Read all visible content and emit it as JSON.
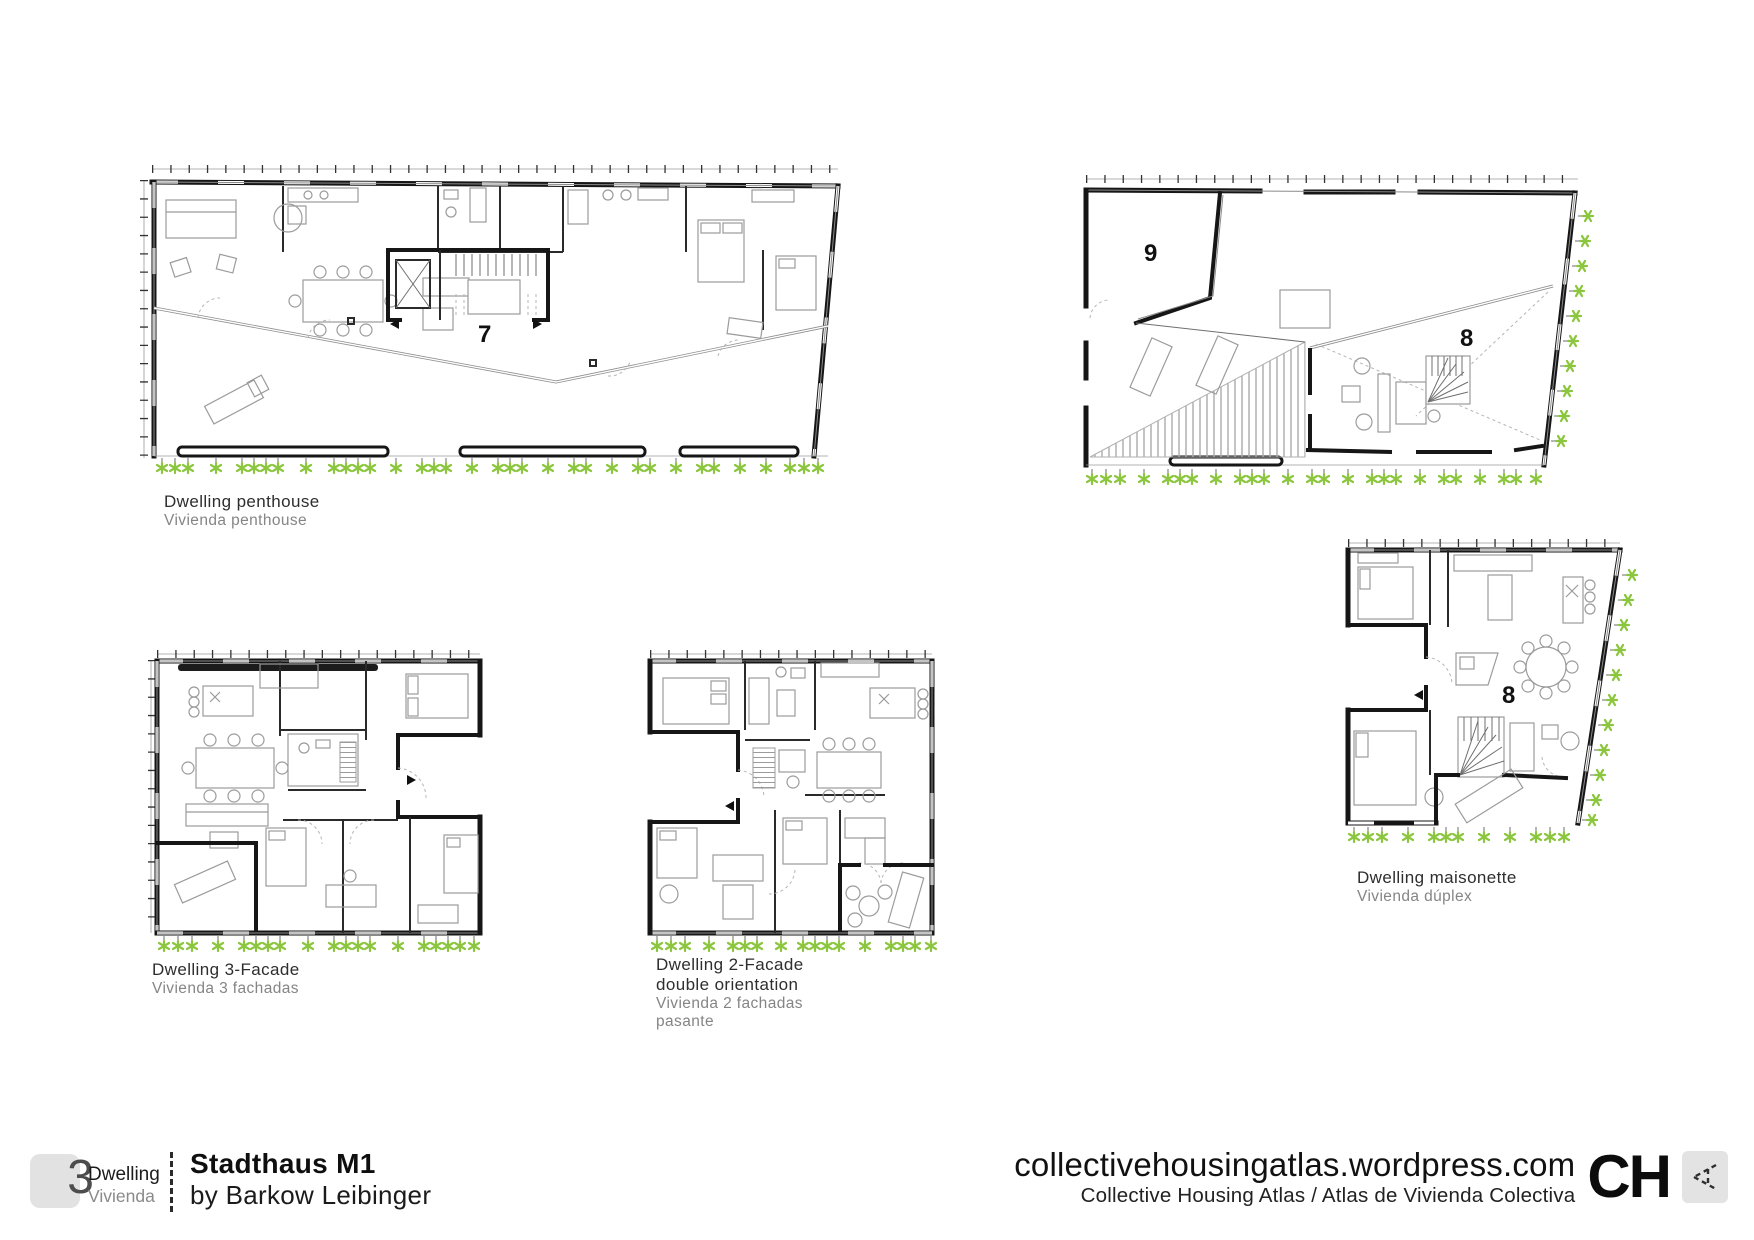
{
  "colors": {
    "wall": "#161616",
    "furniture": "#9b9b9b",
    "plant_green": "#8cc63e",
    "badge_gray": "#e2e2e2"
  },
  "plans": {
    "penthouse": {
      "number": "7",
      "caption_title": "Dwelling penthouse",
      "caption_subtitle": "Vivienda penthouse"
    },
    "roof_terrace": {
      "number_room": "9",
      "number_unit": "8"
    },
    "three_facade": {
      "caption_title": "Dwelling 3-Facade",
      "caption_subtitle": "Vivienda 3 fachadas"
    },
    "two_facade": {
      "caption_title_line1": "Dwelling 2-Facade",
      "caption_title_line2": "double orientation",
      "caption_subtitle_line1": "Vivienda 2 fachadas",
      "caption_subtitle_line2": "pasante"
    },
    "maisonette": {
      "number": "8",
      "caption_title": "Dwelling maisonette",
      "caption_subtitle": "Vivienda dúplex"
    }
  },
  "footer": {
    "unit_count": "3",
    "unit_label_en": "Dwelling",
    "unit_label_es": "Vivienda",
    "project_title": "Stadthaus M1",
    "project_architect": "by Barkow Leibinger",
    "website": "collectivehousingatlas.wordpress.com",
    "site_name": "Collective Housing Atlas / Atlas de Vivienda Colectiva",
    "logo": "CH"
  }
}
